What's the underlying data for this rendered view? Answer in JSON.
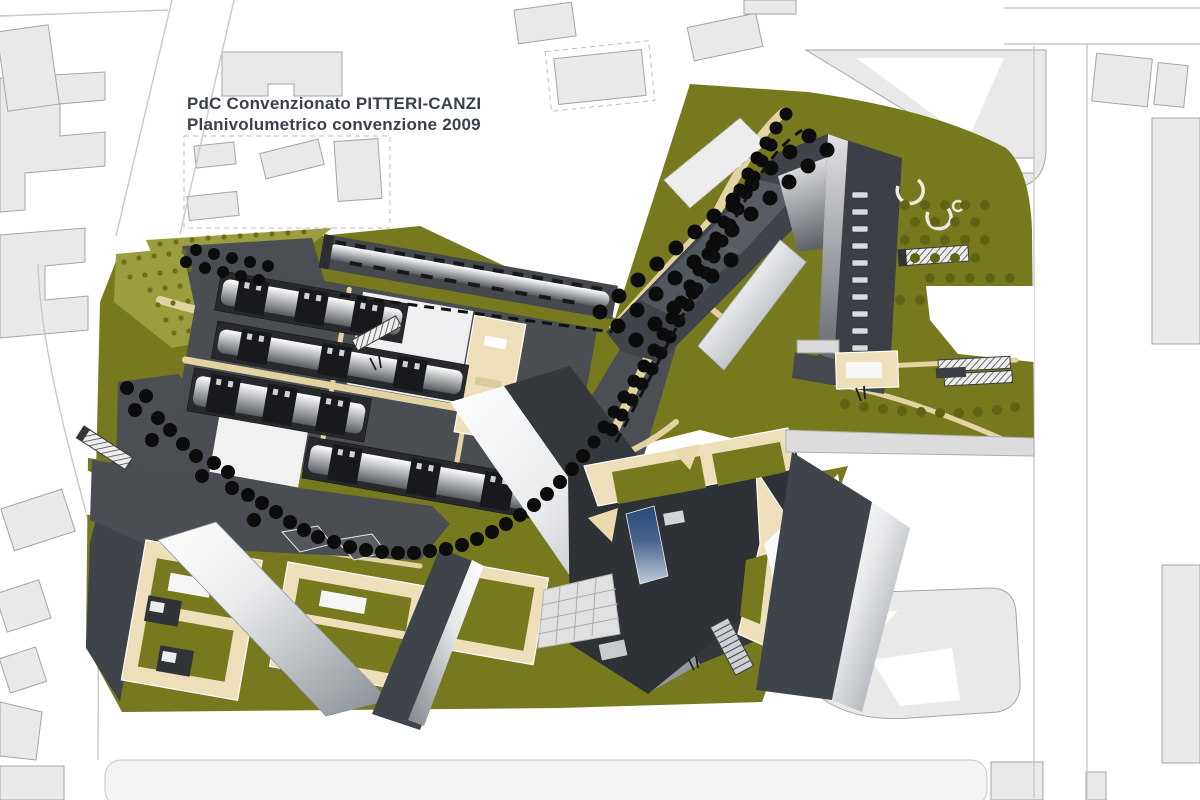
{
  "annotation": {
    "title": "PdC Convenzionato PITTERI-CANZI",
    "subtitle": "Planivolumetrico convenzione 2009"
  },
  "palette": {
    "background": "#ffffff",
    "context_fill": "#e9e9e9",
    "context_stroke": "#a5a5a5",
    "road_line": "#c9c9c9",
    "parcel_olive": "#76791e",
    "olive_light": "#9a9e3e",
    "olive_dot": "#5f6313",
    "building_dark": "#3f434a",
    "plinth_gray": "#4a4d52",
    "path_beige": "#e3d3a2",
    "court_cream": "#ecdfb9",
    "tree_black": "#0c0c0c",
    "glass_blue": "#274a78",
    "paving_light": "#e1e1e1",
    "title_color": "#3b404d"
  }
}
